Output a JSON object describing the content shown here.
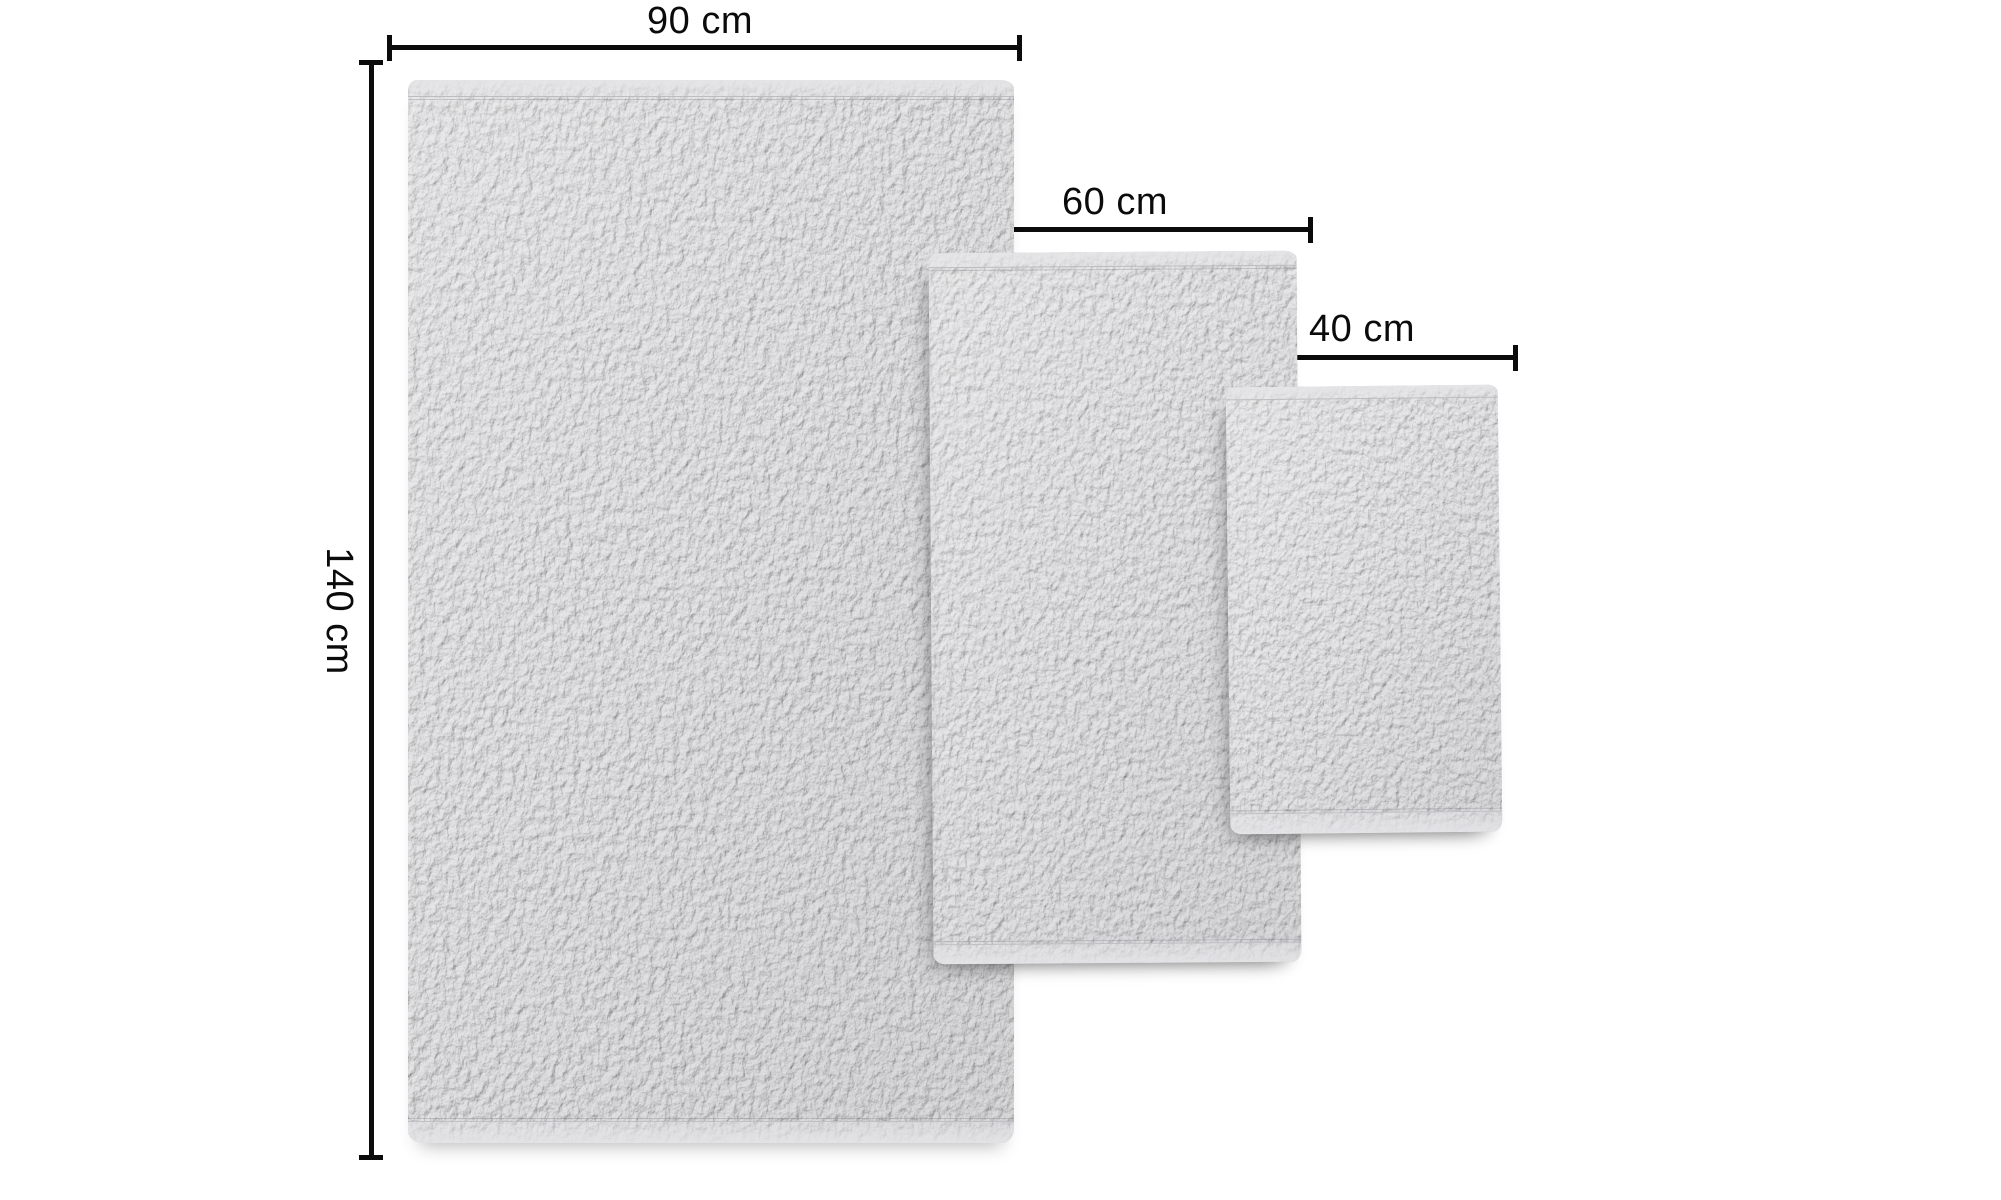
{
  "colors": {
    "background": "#ffffff",
    "annotation": "#0b0b0b",
    "towel_base": "#d6d6d8",
    "towel_hem": "#e4e4e6"
  },
  "towels": [
    {
      "id": "bath-towel",
      "width_label": "90 cm",
      "height_label": "140 cm"
    },
    {
      "id": "hand-towel",
      "width_label": "60 cm",
      "height_label": "90 cm"
    },
    {
      "id": "guest-towel",
      "width_label": "40 cm",
      "height_label": "50 cm"
    }
  ]
}
